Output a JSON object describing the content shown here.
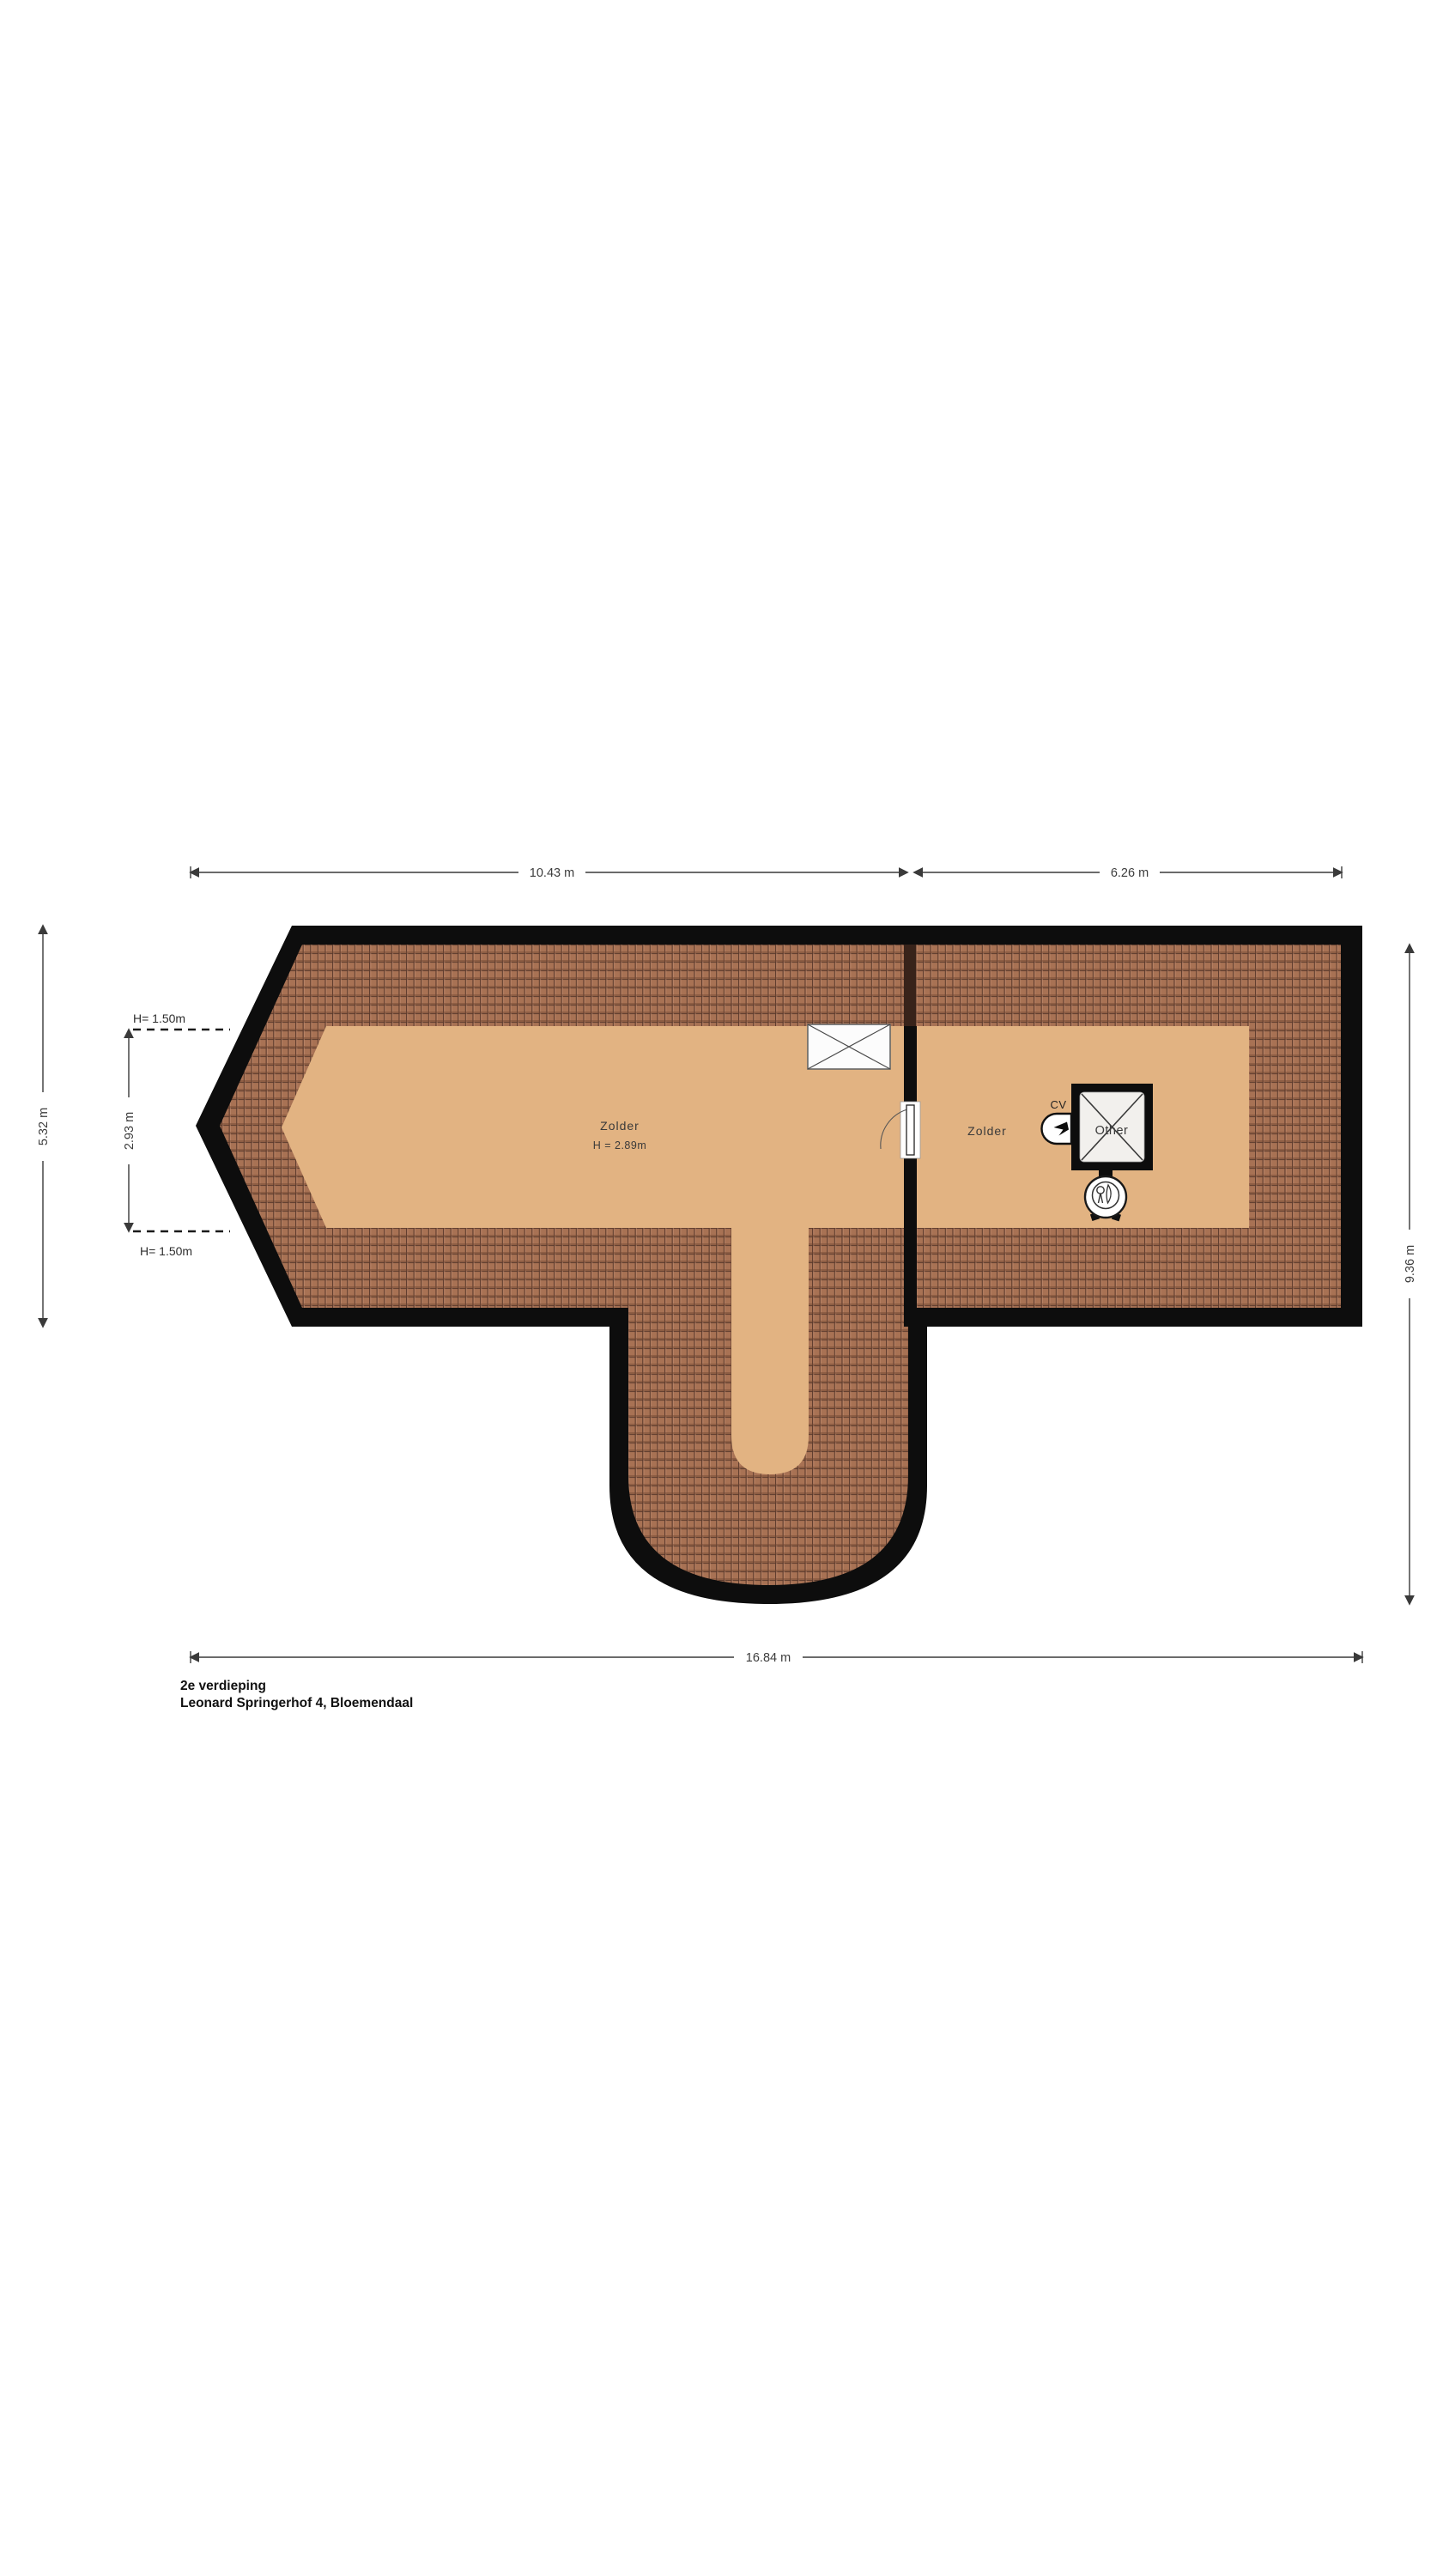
{
  "meta": {
    "floor_label": "2e verdieping",
    "address": "Leonard Springerhof 4, Bloemendaal",
    "drawing_type": "attic floor plan"
  },
  "dimensions": {
    "top_left": "10.43 m",
    "top_right": "6.26 m",
    "bottom": "16.84 m",
    "left_total": "5.32 m",
    "left_inner": "2.93 m",
    "right": "9.36 m",
    "height_marker_top": "H= 1.50m",
    "height_marker_bottom": "H= 1.50m"
  },
  "rooms": {
    "attic_left": {
      "name": "Zolder",
      "height": "H = 2.89m"
    },
    "attic_right": {
      "name": "Zolder"
    },
    "shaft": {
      "name": "Other"
    },
    "cv": {
      "label": "CV"
    }
  },
  "icons": {
    "roof_window": "crossed-rectangle",
    "shaft": "crossed-square",
    "cv_unit": "flame",
    "ventilation_unit": "circle-with-drop",
    "door": "door-with-swing-arc"
  },
  "colors": {
    "wall": "#0d0d0d",
    "tile_base": "#a87254",
    "tile_dark": "#58382a",
    "floor": "#e2b382",
    "dim_line": "#3a3a3a",
    "text": "#3a3a3a",
    "background": "#ffffff"
  }
}
